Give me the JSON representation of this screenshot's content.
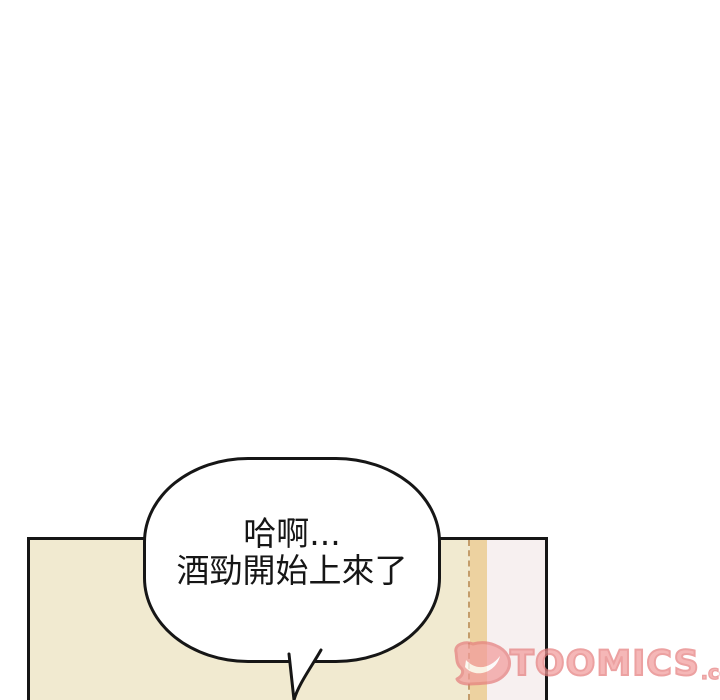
{
  "colors": {
    "page-bg": "#ffffff",
    "ink": "#161616",
    "panel-fill": "#f1ead0",
    "frame-stripe": "#edd2a0",
    "frame-line": "#b98a52",
    "wall-pink": "#f7f0f0",
    "bubble-fill": "#ffffff",
    "watermark-fill": "#f29c9c",
    "watermark-outline": "#e57e7e"
  },
  "speech_bubble": {
    "line1": "哈啊...",
    "line2": "酒勁開始上來了"
  },
  "watermark": {
    "logo_icon": "toomics-smile-logo",
    "brand": "TOOMICS",
    "suffix": ".com"
  }
}
